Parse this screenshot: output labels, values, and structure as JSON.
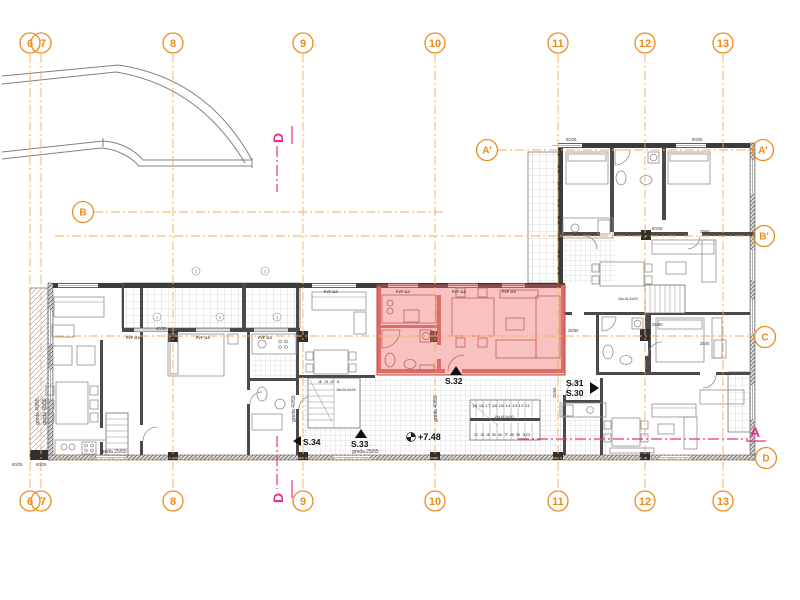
{
  "palette": {
    "grid_orange": "#EE8A1B",
    "grid_line_orange": "#F3AC64",
    "section_magenta": "#EA2E8F",
    "wall_dark": "#3b3b3b",
    "furniture_gray": "#8f8f8f",
    "highlight_fill": "#f0a39e",
    "highlight_wall": "#d8706b"
  },
  "grid": {
    "cols": [
      "6",
      "7",
      "8",
      "9",
      "10",
      "11",
      "12",
      "13"
    ],
    "rows": {
      "a_left": "A'",
      "a_right": "A'",
      "b_left": "B",
      "b_prime": "B'",
      "c": "C",
      "d": "D"
    }
  },
  "sections": {
    "top": "D",
    "bottom": "D",
    "side": "A"
  },
  "units": {
    "s30": "S.30",
    "s31": "S.31",
    "s32": "S.32",
    "s33": "S.33",
    "s34": "S.34"
  },
  "levels": {
    "corridor": "+7.48"
  },
  "stairs": {
    "main_upper": "19 18 17 16 15 14 13 12 11",
    "main_lower": "2 3 4 5 6 7 8 9 10",
    "main_spec": "19x16,5x30",
    "west_upper": "4 3 2 1",
    "west_spec": "16x16,5x28",
    "east_spec": "16x16,4x29"
  },
  "beams": {
    "left_a": "greda 40/55",
    "left_b": "greda 40/55",
    "mid": "greda 40/55",
    "stair": "greda 40/55",
    "bottom_a": "greda 25/55",
    "bottom_b": "greda 25/55"
  },
  "dims": {
    "v2560": "2560",
    "v2540": "2540",
    "w8025_a": "80/25",
    "w8025_b": "80/25",
    "w8025_c": "80/25",
    "w6025_a": "60/25",
    "w6025_b": "60/25",
    "w2560_a": "25/60",
    "w2560_b": "25/60",
    "w2555": "25/55",
    "w4055": "40/55"
  },
  "windows": {
    "pvf": "PVF 110"
  },
  "misc": {
    "marker": "1"
  }
}
